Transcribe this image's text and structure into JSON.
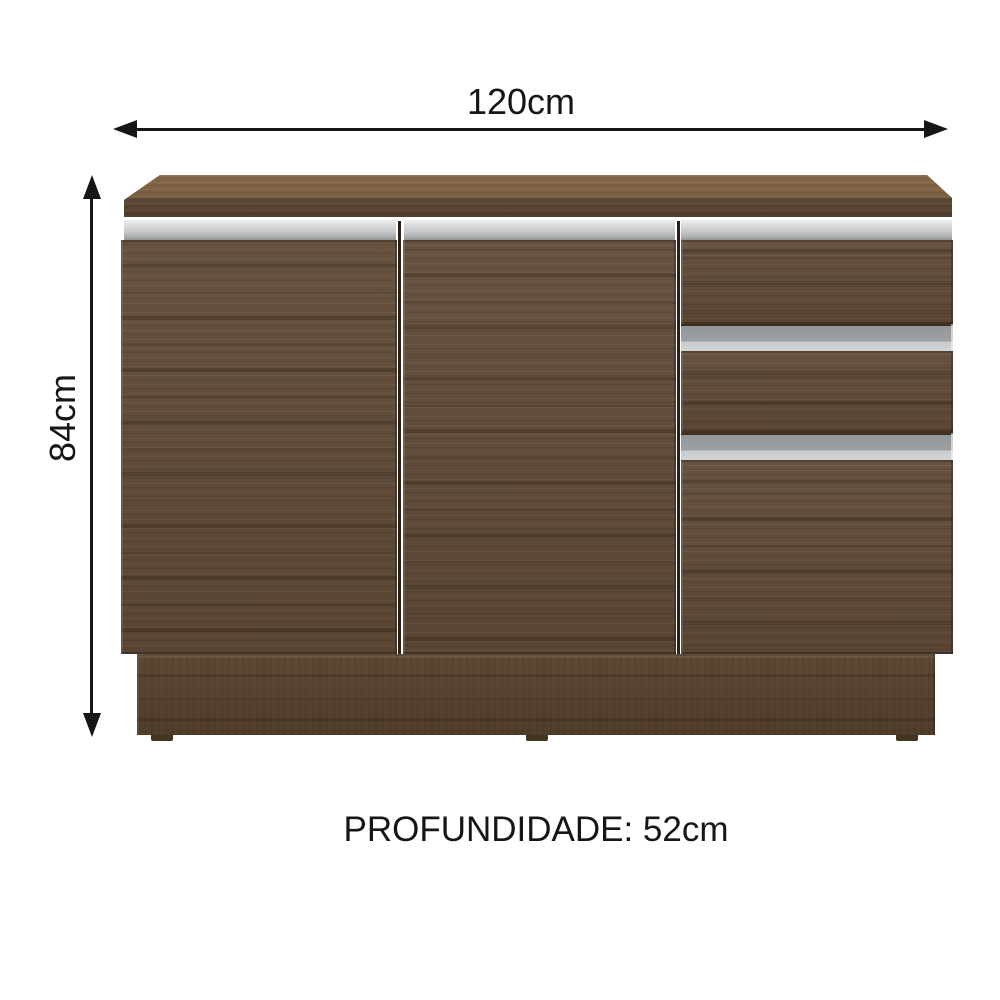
{
  "diagram": {
    "width_label": "120cm",
    "height_label": "84cm",
    "depth_label": "PROFUNDIDADE: 52cm"
  },
  "colors": {
    "background": "#ffffff",
    "annotation": "#161616",
    "wood_top_surface": "#86684a",
    "wood_body": "#5e4935",
    "wood_base": "#59442f",
    "handle_gray_light": "#d7d9da",
    "handle_gray_mid": "#9da0a2"
  }
}
